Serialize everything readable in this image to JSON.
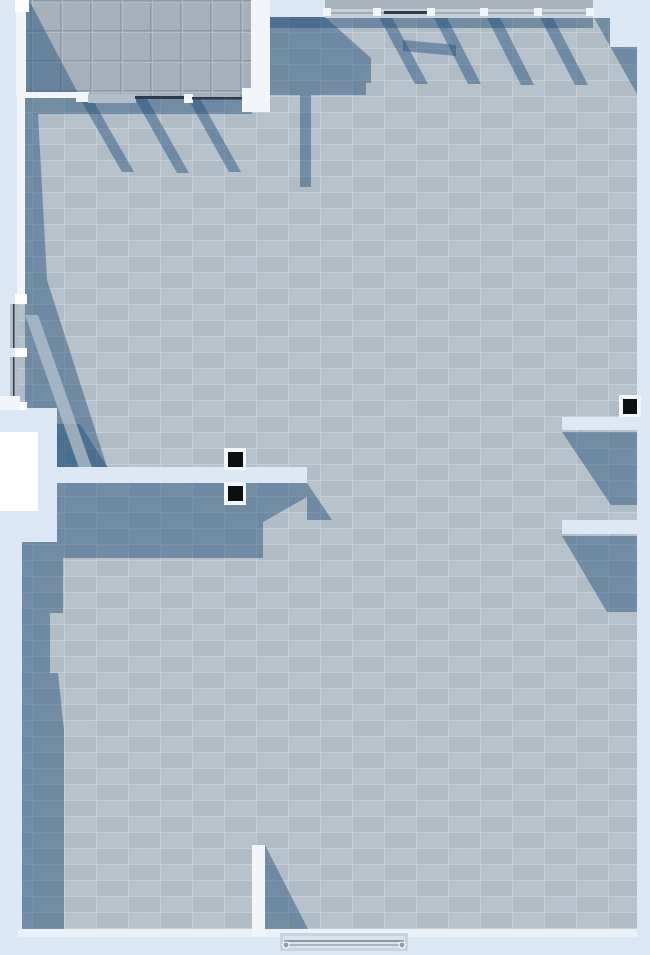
{
  "meta": {
    "view": "top-down-interior-render",
    "width": 650,
    "height": 955
  },
  "colors": {
    "outside": "#dbe7f4",
    "floorBase": "#b7c3cd",
    "floorAlt": "#b1bdc7",
    "floorGrid": "#c8d2da",
    "roomBase": "#a6b1bd",
    "roomGroove": "#8e99a7",
    "roomHi": "#b9c3cd",
    "shadow": "#1f4e76",
    "wallWhite": "#f2f6fb",
    "wallBright": "#ffffff",
    "wallStrip": "#dce8f3",
    "wallTop": "#a9b3bd",
    "wallFace": "#c6cfd7",
    "glassDark": "#2c3c4b",
    "glassLight": "#9fabb6",
    "doorPanel": "#b3bdc7",
    "black": "#0c0f12",
    "edgeLight": "#e9f0f7",
    "doorFrame": "#c9d3dc",
    "doorGlass": "#d9e3ed",
    "rail1": "#8b98a5",
    "rail2": "#a9b5c1",
    "handle": "#8f9ca9"
  },
  "scene": {
    "floor": "large tiled hall",
    "upper_room": "small gridded room, top-left",
    "columns": [
      "black-capped column pair at center wall",
      "black-capped column at right wall"
    ],
    "doors": [
      "glass wall with sliding door below upper room",
      "double door on west wall",
      "glass entry door on south wall"
    ],
    "shadow_opacity": 0.45,
    "light_direction": "from upper-left"
  }
}
